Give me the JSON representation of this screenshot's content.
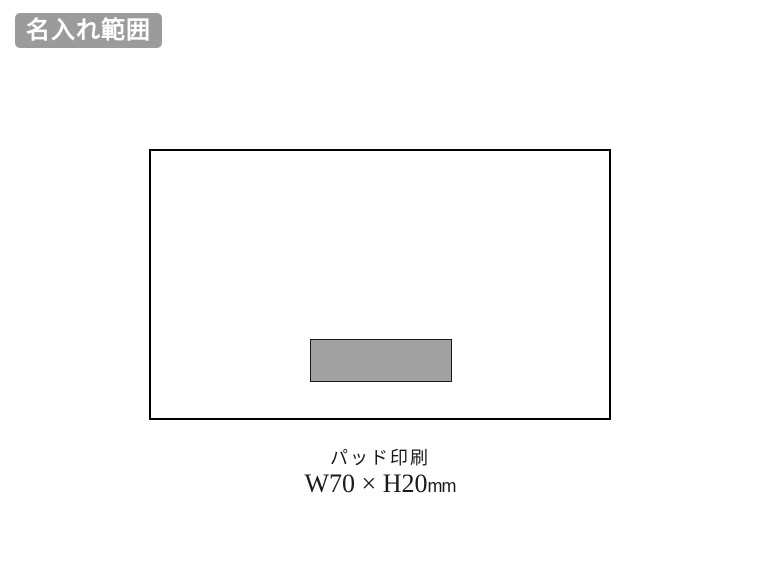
{
  "page": {
    "background": "#ffffff"
  },
  "badge": {
    "label": "名入れ範囲",
    "background": "#9b9b9b",
    "text_color": "#ffffff"
  },
  "diagram": {
    "product_outline": {
      "border_color": "#000000",
      "fill": "#ffffff"
    },
    "print_area": {
      "fill": "#a1a1a1",
      "border_color": "#1a1a1a"
    },
    "caption": {
      "method": "パッド印刷",
      "size": "W70 × H20",
      "unit": "mm"
    }
  }
}
